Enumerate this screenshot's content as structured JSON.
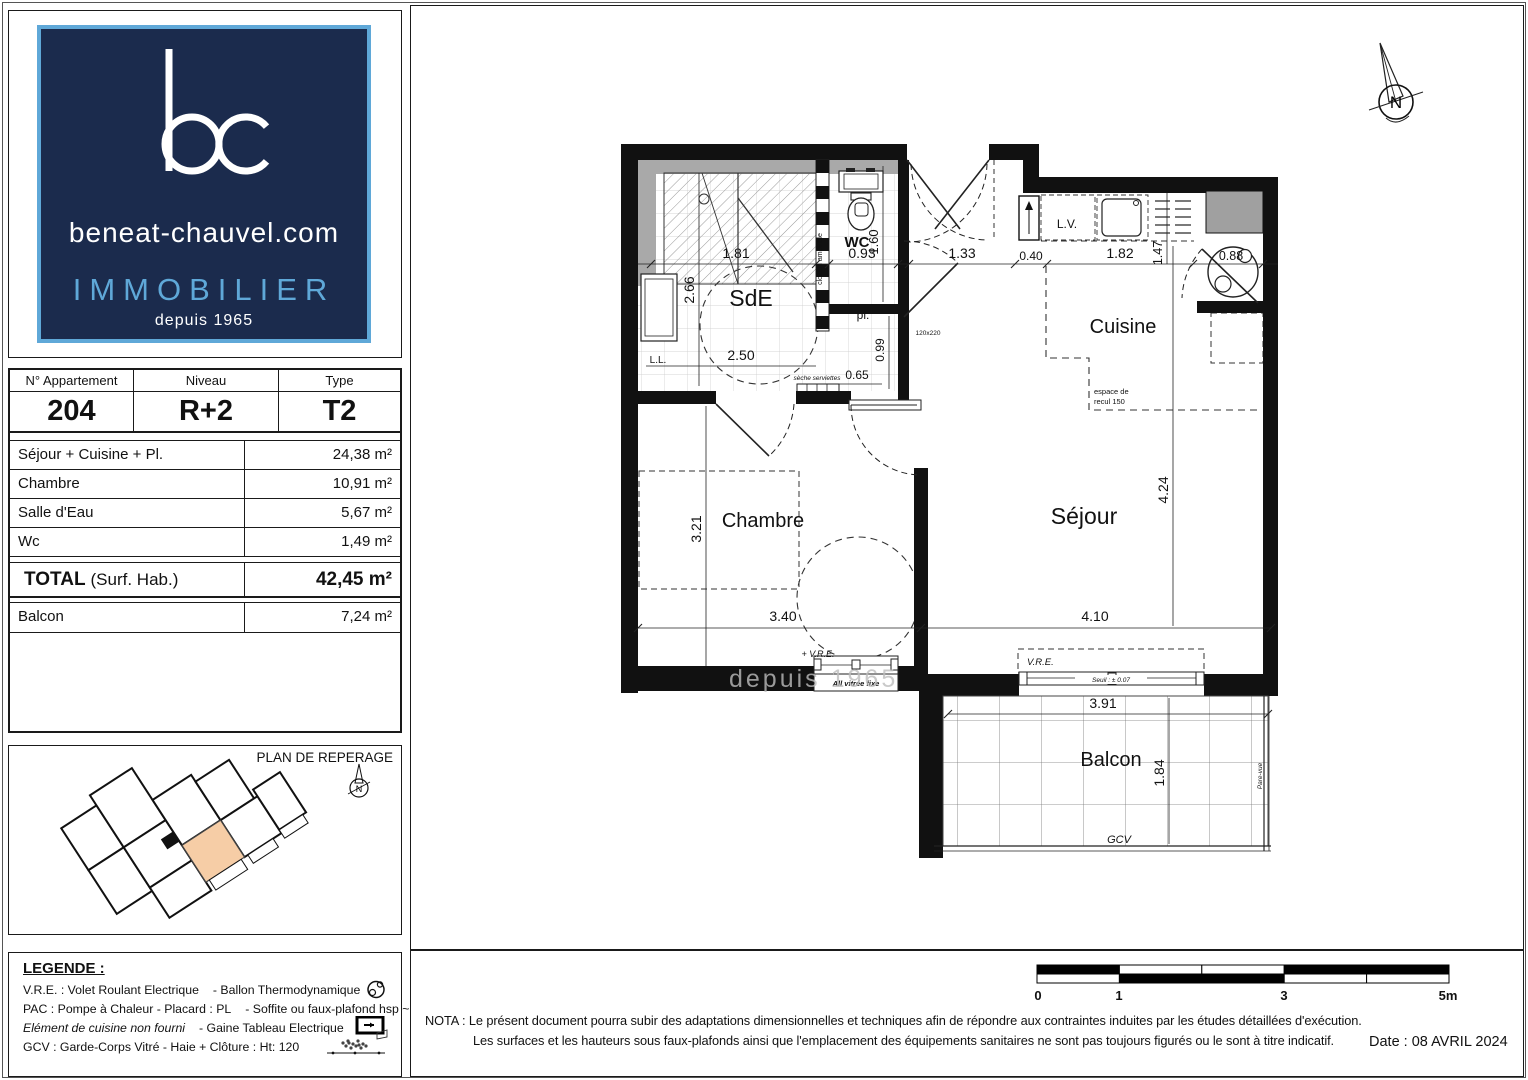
{
  "logo": {
    "monogram": "bc",
    "domain": "beneat-chauvel.com",
    "brand": "IMMOBILIER",
    "since": "depuis 1965"
  },
  "info": {
    "col1": "N° Appartement",
    "col2": "Niveau",
    "col3": "Type",
    "apartment": "204",
    "level": "R+2",
    "type": "T2"
  },
  "areas": {
    "rows": [
      {
        "label": "Séjour + Cuisine + Pl.",
        "value": "24,38 m²"
      },
      {
        "label": "Chambre",
        "value": "10,91 m²"
      },
      {
        "label": "Salle d'Eau",
        "value": "5,67 m²"
      },
      {
        "label": "Wc",
        "value": "1,49 m²"
      }
    ],
    "total_label": "TOTAL",
    "total_note": "(Surf. Hab.)",
    "total_value": "42,45 m²",
    "balcony_label": "Balcon",
    "balcony_value": "7,24 m²"
  },
  "reperage": {
    "title": "PLAN DE REPERAGE",
    "north": "N"
  },
  "legende": {
    "title": "LEGENDE :",
    "l1a": "V.R.E. : Volet Roulant Electrique",
    "l1b": "- Ballon Thermodynamique",
    "l2a": "PAC : Pompe à Chaleur - Placard : PL",
    "l2b": "- Soffite ou faux-plafond hsp ~230",
    "l3a": "Elément de cuisine non fourni",
    "l3b": "- Gaine Tableau Electrique",
    "l4": "GCV : Garde-Corps Vitré - Haie + Clôture : Ht: 120"
  },
  "plan": {
    "rooms": {
      "sde": "SdE",
      "wc": "WC",
      "pl": "pl.",
      "cuisine": "Cuisine",
      "chambre": "Chambre",
      "sejour": "Séjour",
      "balcon": "Balcon"
    },
    "dims": {
      "d181": "1.81",
      "d093": "0.93",
      "d133": "1.33",
      "d040": "0.40",
      "d182": "1.82",
      "d147": "1.47",
      "d088": "0.88",
      "d266": "2.66",
      "d160": "1.60",
      "d250": "2.50",
      "d099": "0.99",
      "d065": "0.65",
      "d321": "3.21",
      "d340": "3.40",
      "d424": "4.24",
      "d410": "4.10",
      "d391": "3.91",
      "d184": "1.84"
    },
    "annot": {
      "ll": "L.L.",
      "lv": "L.V.",
      "seche": "sèche serviettes",
      "cloison": "cloison amovible",
      "door_size": "120x220",
      "recul1": "espace de",
      "recul2": "recul 150",
      "vre": "V.R.E.",
      "vre_plus": "+ V.R.E.",
      "vitree": "All vitrée fixe",
      "seuil": "Seuil : ± 0.07",
      "gcv": "GCV",
      "parevue": "Pare-vue",
      "north": "N",
      "watermark": "depuis 1965"
    }
  },
  "scalebar": {
    "t0": "0",
    "t1": "1",
    "t3": "3",
    "t5": "5m"
  },
  "nota": {
    "label": "NOTA :",
    "line1": "Le présent document pourra subir des adaptations dimensionnelles et techniques afin de répondre aux contraintes induites par les études détaillées d'exécution.",
    "line2": "Les surfaces et les hauteurs sous faux-plafonds ainsi que l'emplacement des équipements sanitaires ne sont pas toujours figurés ou le sont à titre indicatif.",
    "date": "Date : 08 AVRIL 2024"
  },
  "colors": {
    "navy": "#1B2B4D",
    "lightblue": "#5FA8D8",
    "orange": "#F6CDA6",
    "wall": "#111111",
    "gray": "#A9A9A9"
  }
}
